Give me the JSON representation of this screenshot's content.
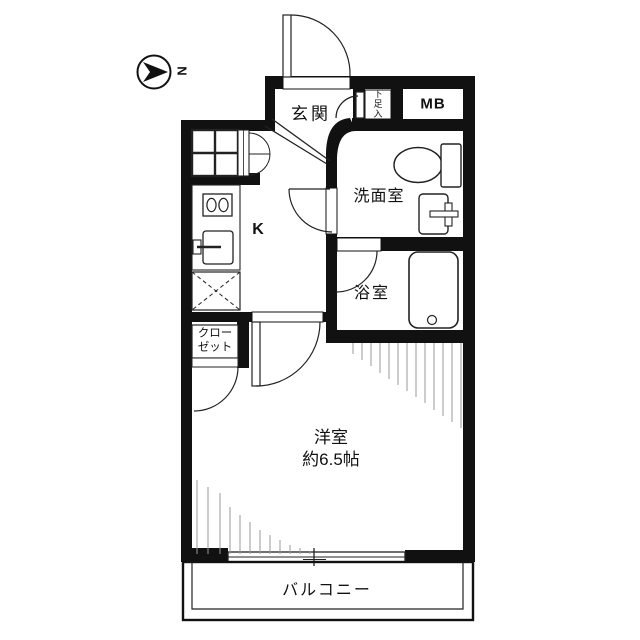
{
  "compass": {
    "label": "N"
  },
  "labels": {
    "genkan": "玄関",
    "shoe_storage": "下足入",
    "meter_box": "MB",
    "washroom": "洗面室",
    "kitchen": "K",
    "bathroom": "浴室",
    "closet_line1": "クロー",
    "closet_line2": "ゼット",
    "main_room_name": "洋室",
    "main_room_size": "約6.5帖",
    "balcony": "バルコニー"
  },
  "colors": {
    "wall": "#111111",
    "line": "#222222",
    "hatch": "#999999",
    "background": "#ffffff"
  }
}
